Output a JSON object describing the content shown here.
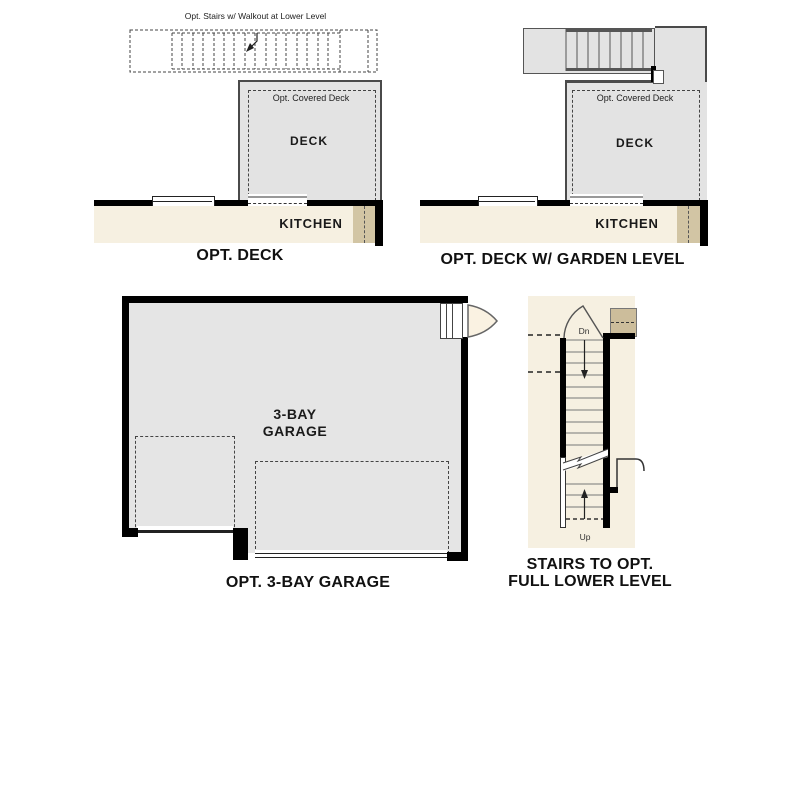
{
  "colors": {
    "wall": "#000000",
    "deck_fill": "#e3e3e3",
    "deck_border": "#4a4a4a",
    "floor_cream": "#f6f0e1",
    "cabinet_tan": "#d2c5a4",
    "garage_fill": "#e5e5e5",
    "stairs_tan": "#ccbd9b",
    "line_dark": "#444444"
  },
  "plans": {
    "opt_deck": {
      "caption": "OPT. DECK",
      "stairs_note": "Opt. Stairs w/ Walkout at Lower Level",
      "covered_deck_label": "Opt. Covered Deck",
      "deck_label": "DECK",
      "kitchen_label": "KITCHEN"
    },
    "opt_deck_garden": {
      "caption": "OPT. DECK W/ GARDEN LEVEL",
      "covered_deck_label": "Opt. Covered Deck",
      "deck_label": "DECK",
      "kitchen_label": "KITCHEN"
    },
    "garage": {
      "caption": "OPT. 3-BAY GARAGE",
      "room_label_line1": "3-BAY",
      "room_label_line2": "GARAGE"
    },
    "stairs_detail": {
      "caption_line1": "STAIRS TO OPT.",
      "caption_line2": "FULL LOWER LEVEL",
      "down_label": "Dn",
      "up_label": "Up"
    }
  }
}
